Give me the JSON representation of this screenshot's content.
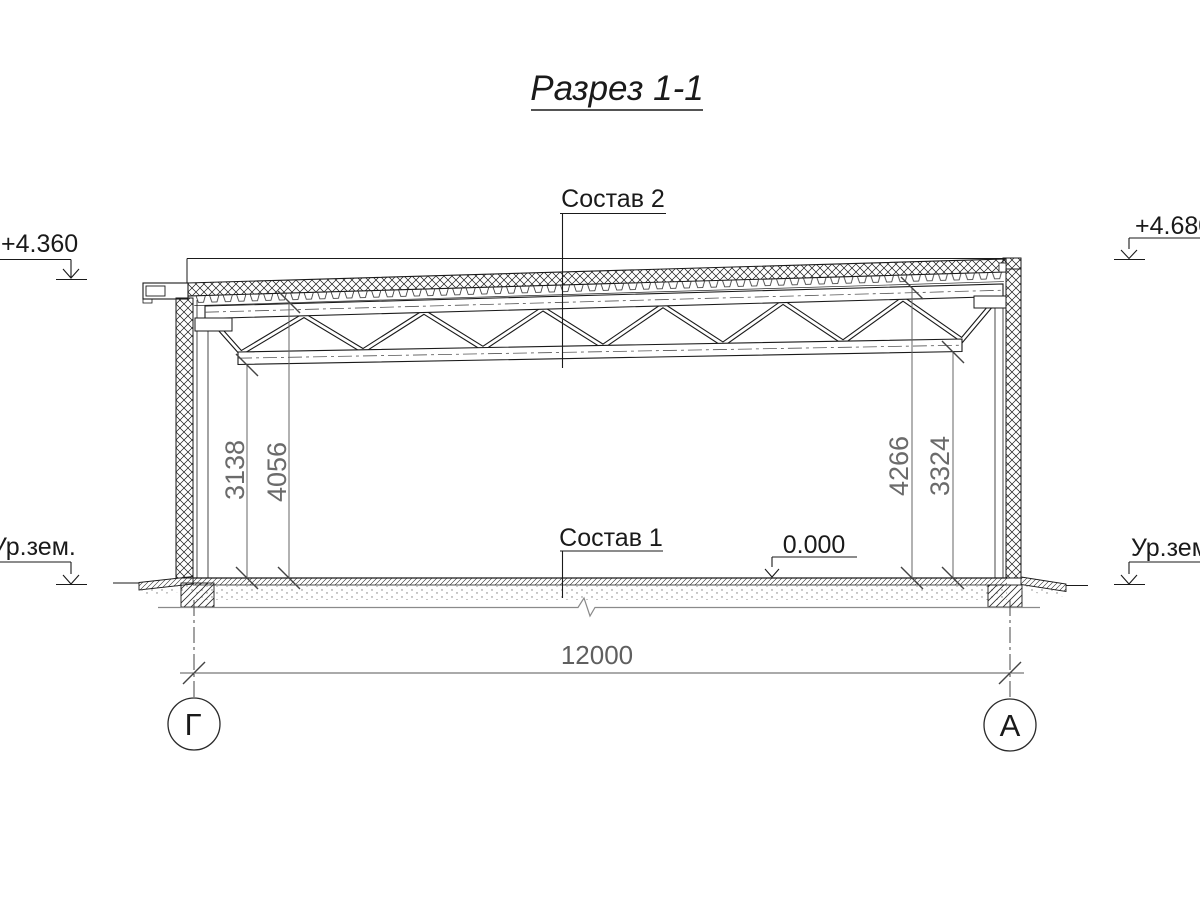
{
  "title": "Разрез 1-1",
  "annotations": {
    "roof_composition": "Состав 2",
    "floor_composition": "Состав 1",
    "zero_level": "0.000",
    "ground_level_left": "Ур.зем.",
    "ground_level_right": "Ур.зем.",
    "elevation_left": "+4.360",
    "elevation_right": "+4.680"
  },
  "dimensions": {
    "span": "12000",
    "left_clear_height": "3138",
    "left_roof_height": "4056",
    "right_roof_height": "4266",
    "right_clear_height": "3324"
  },
  "axes": {
    "left_label": "Г",
    "right_label": "А"
  },
  "colors": {
    "ink": "#1a1a1a",
    "dimension": "#666666",
    "foundation_base_line": "#8a8a8a"
  }
}
